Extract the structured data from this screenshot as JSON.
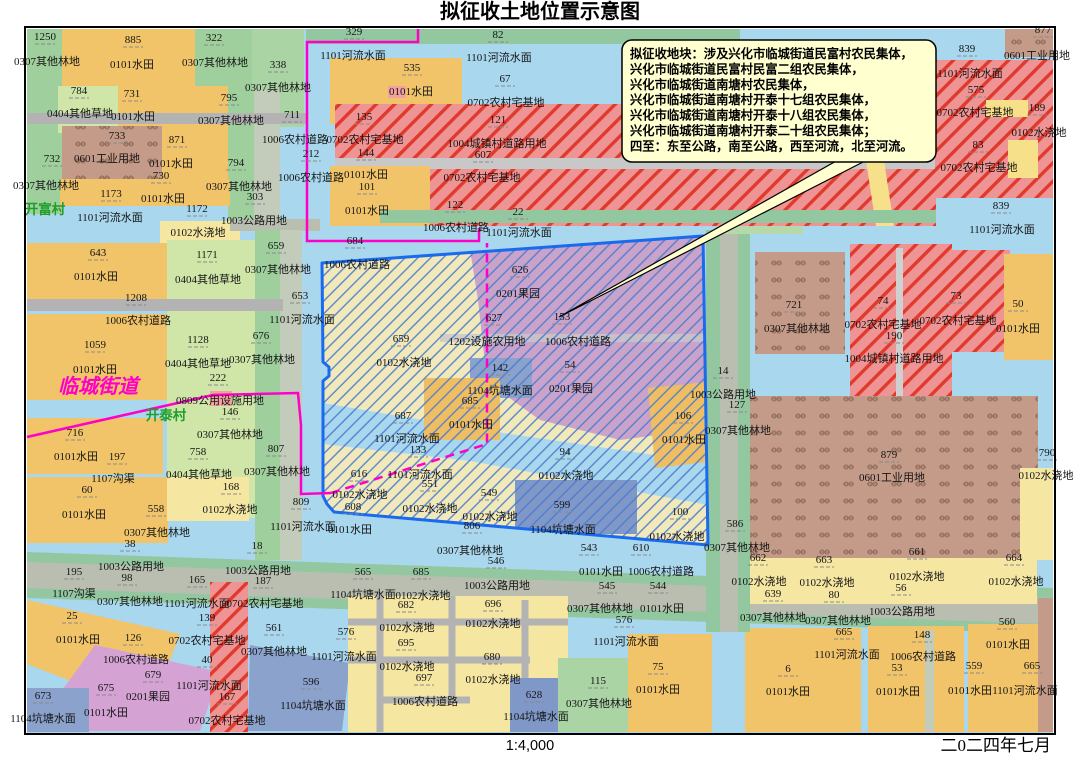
{
  "title": "拟征收土地位置示意图",
  "scale_label": "1:4,000",
  "date_label": "二0二四年七月",
  "callout": {
    "lines": [
      "拟征收地块：涉及兴化市临城街道民富村农民集体，",
      "兴化市临城街道民富村民富二组农民集体，",
      "兴化市临城街道南塘村农民集体，",
      "兴化市临城街道南塘村开泰十七组农民集体，",
      "兴化市临城街道南塘村开泰十八组农民集体，",
      "兴化市临城街道南塘村开泰二十组农民集体；",
      "四至：东至公路，南至公路，西至河流，北至河流。"
    ]
  },
  "legend_colors": {
    "water": "#a9d7ee",
    "paddy_field": "#f2c469",
    "irrigated_land": "#f5e6a2",
    "forest_strip": "#9fcf9c",
    "grass": "#cfe6a8",
    "village_road": "#b3b3b3",
    "highway": "#b9beb0",
    "road_verge": "#93c7a0",
    "residential_red": "#ef9494",
    "residential_hatch": "#e03a2e",
    "industrial_brown": "#c49a88",
    "orchard_purple": "#c9a3c9",
    "orchard_pink": "#d4a3d4",
    "pond_slate": "#8aa2cc",
    "zone_border": "#1a6aee",
    "zone_hatch": "#4a7cd0",
    "admin_boundary": "#ff00c8",
    "village_text": "#1f9e2c",
    "callout_bg": "#ffffd0"
  },
  "map": {
    "labels": [
      [
        45,
        40,
        "1250",
        "n"
      ],
      [
        47,
        65,
        "0307其他林地",
        "c"
      ],
      [
        133,
        43,
        "885",
        "n"
      ],
      [
        132,
        68,
        "0101水田",
        "c"
      ],
      [
        214,
        41,
        "322",
        "n"
      ],
      [
        215,
        66,
        "0307其他林地",
        "c"
      ],
      [
        278,
        68,
        "338",
        "n"
      ],
      [
        278,
        91,
        "0307其他林地",
        "c"
      ],
      [
        79,
        94,
        "784",
        "n"
      ],
      [
        132,
        97,
        "731",
        "n"
      ],
      [
        80,
        117,
        "0404其他草地",
        "c"
      ],
      [
        133,
        120,
        "0101水田",
        "c"
      ],
      [
        229,
        101,
        "795",
        "n"
      ],
      [
        231,
        124,
        "0307其他林地",
        "c"
      ],
      [
        292,
        118,
        "711",
        "n"
      ],
      [
        295,
        143,
        "1006农村道路",
        "c"
      ],
      [
        117,
        139,
        "733",
        "n"
      ],
      [
        107,
        162,
        "0601工业用地",
        "c"
      ],
      [
        177,
        143,
        "871",
        "n"
      ],
      [
        171,
        167,
        "0101水田",
        "c"
      ],
      [
        161,
        179,
        "730",
        "n"
      ],
      [
        52,
        162,
        "732",
        "n"
      ],
      [
        46,
        189,
        "0307其他林地",
        "c"
      ],
      [
        236,
        166,
        "794",
        "n"
      ],
      [
        239,
        190,
        "0307其他林地",
        "c"
      ],
      [
        255,
        200,
        "303",
        "n"
      ],
      [
        111,
        197,
        "1173",
        "n"
      ],
      [
        163,
        202,
        "0101水田",
        "c"
      ],
      [
        45,
        214,
        "开富村",
        "v"
      ],
      [
        110,
        221,
        "1101河流水面",
        "c"
      ],
      [
        197,
        212,
        "1172",
        "n"
      ],
      [
        254,
        224,
        "1003公路用地",
        "c"
      ],
      [
        198,
        236,
        "0102水浇地",
        "c"
      ],
      [
        276,
        249,
        "659",
        "n"
      ],
      [
        278,
        273,
        "0307其他林地",
        "c"
      ],
      [
        207,
        258,
        "1171",
        "n"
      ],
      [
        208,
        283,
        "0404其他草地",
        "c"
      ],
      [
        98,
        256,
        "643",
        "n"
      ],
      [
        96,
        280,
        "0101水田",
        "c"
      ],
      [
        136,
        301,
        "1208",
        "n"
      ],
      [
        138,
        324,
        "1006农村道路",
        "c"
      ],
      [
        300,
        299,
        "653",
        "n"
      ],
      [
        302,
        323,
        "1101河流水面",
        "c"
      ],
      [
        95,
        348,
        "1059",
        "n"
      ],
      [
        95,
        373,
        "0101水田",
        "c"
      ],
      [
        198,
        343,
        "1128",
        "n"
      ],
      [
        198,
        367,
        "0404其他草地",
        "c"
      ],
      [
        261,
        339,
        "676",
        "n"
      ],
      [
        262,
        363,
        "0307其他林地",
        "c"
      ],
      [
        218,
        381,
        "222",
        "n"
      ],
      [
        98,
        393,
        "临城街道",
        "t"
      ],
      [
        220,
        404,
        "0809公用设施用地",
        "c"
      ],
      [
        230,
        415,
        "146",
        "n"
      ],
      [
        166,
        420,
        "开泰村",
        "v"
      ],
      [
        230,
        438,
        "0307其他林地",
        "c"
      ],
      [
        75,
        436,
        "716",
        "n"
      ],
      [
        76,
        460,
        "0101水田",
        "c"
      ],
      [
        117,
        460,
        "197",
        "n"
      ],
      [
        198,
        455,
        "758",
        "n"
      ],
      [
        276,
        452,
        "807",
        "n"
      ],
      [
        277,
        475,
        "0307其他林地",
        "c"
      ],
      [
        113,
        482,
        "1107沟渠",
        "c"
      ],
      [
        87,
        493,
        "60",
        "n"
      ],
      [
        199,
        478,
        "0404其他草地",
        "c"
      ],
      [
        231,
        490,
        "168",
        "n"
      ],
      [
        156,
        512,
        "558",
        "n"
      ],
      [
        84,
        518,
        "0101水田",
        "c"
      ],
      [
        230,
        513,
        "0102水浇地",
        "c"
      ],
      [
        157,
        536,
        "0307其他林地",
        "c"
      ],
      [
        130,
        547,
        "38",
        "n"
      ],
      [
        301,
        505,
        "809",
        "n"
      ],
      [
        303,
        530,
        "1101河流水面",
        "c"
      ],
      [
        350,
        533,
        "0101水田",
        "c"
      ],
      [
        74,
        575,
        "195",
        "n"
      ],
      [
        131,
        570,
        "1003公路用地",
        "c"
      ],
      [
        127,
        581,
        "98",
        "n"
      ],
      [
        257,
        549,
        "18",
        "n"
      ],
      [
        258,
        574,
        "1003公路用地",
        "c"
      ],
      [
        197,
        583,
        "165",
        "n"
      ],
      [
        263,
        584,
        "187",
        "n"
      ],
      [
        74,
        597,
        "1107沟渠",
        "c"
      ],
      [
        130,
        605,
        "0307其他林地",
        "c"
      ],
      [
        197,
        607,
        "1101河流水面",
        "c"
      ],
      [
        265,
        607,
        "0702农村宅基地",
        "c"
      ],
      [
        207,
        621,
        "139",
        "n"
      ],
      [
        72,
        619,
        "25",
        "n"
      ],
      [
        78,
        643,
        "0101水田",
        "c"
      ],
      [
        133,
        641,
        "126",
        "n"
      ],
      [
        207,
        644,
        "0702农村宅基地",
        "c"
      ],
      [
        274,
        631,
        "561",
        "n"
      ],
      [
        274,
        655,
        "0307其他林地",
        "c"
      ],
      [
        136,
        663,
        "1006农村道路",
        "c"
      ],
      [
        153,
        678,
        "679",
        "n"
      ],
      [
        207,
        663,
        "40",
        "n"
      ],
      [
        106,
        691,
        "675",
        "n"
      ],
      [
        148,
        700,
        "0201果园",
        "c"
      ],
      [
        209,
        689,
        "1101河流水面",
        "c"
      ],
      [
        227,
        700,
        "167",
        "n"
      ],
      [
        311,
        685,
        "596",
        "n"
      ],
      [
        313,
        709,
        "1104坑塘水面",
        "c"
      ],
      [
        43,
        699,
        "673",
        "n"
      ],
      [
        43,
        722,
        "1104坑塘水面",
        "c"
      ],
      [
        106,
        716,
        "0101水田",
        "c"
      ],
      [
        227,
        724,
        "0702农村宅基地",
        "c"
      ],
      [
        354,
        35,
        "329",
        "n"
      ],
      [
        498,
        38,
        "82",
        "n"
      ],
      [
        353,
        59,
        "1101河流水面",
        "c"
      ],
      [
        412,
        71,
        "535",
        "n"
      ],
      [
        499,
        61,
        "1101河流水面",
        "c"
      ],
      [
        411,
        95,
        "0101水田",
        "c"
      ],
      [
        505,
        82,
        "67",
        "n"
      ],
      [
        506,
        106,
        "0702农村宅基地",
        "c"
      ],
      [
        364,
        120,
        "135",
        "n"
      ],
      [
        498,
        123,
        "121",
        "n"
      ],
      [
        365,
        143,
        "0702农村宅基地",
        "c"
      ],
      [
        366,
        156,
        "144",
        "n"
      ],
      [
        497,
        147,
        "1004城镇村道路用地",
        "c"
      ],
      [
        483,
        158,
        "607",
        "n"
      ],
      [
        482,
        181,
        "0702农村宅基地",
        "c"
      ],
      [
        311,
        157,
        "212",
        "n"
      ],
      [
        311,
        181,
        "1006农村道路",
        "c"
      ],
      [
        366,
        178,
        "0101水田",
        "c"
      ],
      [
        367,
        190,
        "101",
        "n"
      ],
      [
        367,
        214,
        "0101水田",
        "c"
      ],
      [
        455,
        208,
        "122",
        "n"
      ],
      [
        518,
        215,
        "22",
        "n"
      ],
      [
        456,
        231,
        "1006农村道路",
        "c"
      ],
      [
        519,
        236,
        "1101河流水面",
        "c"
      ],
      [
        355,
        244,
        "684",
        "n"
      ],
      [
        1043,
        33,
        "877",
        "n"
      ],
      [
        1037,
        59,
        "0601工业用地",
        "c"
      ],
      [
        967,
        52,
        "839",
        "n"
      ],
      [
        970,
        77,
        "1101河流水面",
        "c"
      ],
      [
        976,
        93,
        "575",
        "n"
      ],
      [
        975,
        116,
        "0702农村宅基地",
        "c"
      ],
      [
        1037,
        111,
        "189",
        "n"
      ],
      [
        1039,
        136,
        "0102水浇地",
        "c"
      ],
      [
        978,
        148,
        "83",
        "n"
      ],
      [
        979,
        171,
        "0702农村宅基地",
        "c"
      ],
      [
        1001,
        209,
        "839",
        "n"
      ],
      [
        1002,
        233,
        "1101河流水面",
        "c"
      ],
      [
        357,
        268,
        "1006农村道路",
        "c"
      ],
      [
        520,
        273,
        "626",
        "n"
      ],
      [
        518,
        297,
        "0201果园",
        "c"
      ],
      [
        494,
        321,
        "627",
        "n"
      ],
      [
        562,
        320,
        "153",
        "n"
      ],
      [
        487,
        345,
        "1202设施农用地",
        "c"
      ],
      [
        578,
        345,
        "1006农村道路",
        "c"
      ],
      [
        401,
        342,
        "659",
        "n"
      ],
      [
        404,
        366,
        "0102水浇地",
        "c"
      ],
      [
        500,
        371,
        "142",
        "n"
      ],
      [
        570,
        368,
        "54",
        "n"
      ],
      [
        500,
        394,
        "1104坑塘水面",
        "c"
      ],
      [
        571,
        392,
        "0201果园",
        "c"
      ],
      [
        470,
        404,
        "685",
        "n"
      ],
      [
        471,
        428,
        "0101水田",
        "c"
      ],
      [
        403,
        419,
        "687",
        "n"
      ],
      [
        407,
        442,
        "1101河流水面",
        "c"
      ],
      [
        418,
        453,
        "133",
        "n"
      ],
      [
        359,
        477,
        "616",
        "n"
      ],
      [
        420,
        478,
        "1101河流水面",
        "c"
      ],
      [
        430,
        487,
        "551",
        "n"
      ],
      [
        565,
        455,
        "94",
        "n"
      ],
      [
        566,
        479,
        "0102水浇地",
        "c"
      ],
      [
        683,
        419,
        "106",
        "n"
      ],
      [
        684,
        443,
        "0101水田",
        "c"
      ],
      [
        360,
        498,
        "0102水浇地",
        "c"
      ],
      [
        353,
        510,
        "608",
        "n"
      ],
      [
        430,
        512,
        "0102水浇地",
        "c"
      ],
      [
        489,
        496,
        "549",
        "n"
      ],
      [
        490,
        520,
        "0102水浇地",
        "c"
      ],
      [
        562,
        508,
        "599",
        "n"
      ],
      [
        563,
        533,
        "1104坑塘水面",
        "c"
      ],
      [
        680,
        515,
        "100",
        "n"
      ],
      [
        677,
        540,
        "0102水浇地",
        "c"
      ],
      [
        472,
        529,
        "806",
        "n"
      ],
      [
        470,
        554,
        "0307其他林地",
        "c"
      ],
      [
        496,
        564,
        "546",
        "n"
      ],
      [
        589,
        551,
        "543",
        "n"
      ],
      [
        641,
        551,
        "610",
        "n"
      ],
      [
        794,
        308,
        "721",
        "n"
      ],
      [
        797,
        332,
        "0307其他林地",
        "c"
      ],
      [
        883,
        304,
        "74",
        "n"
      ],
      [
        883,
        328,
        "0702农村宅基地",
        "c"
      ],
      [
        894,
        339,
        "190",
        "n"
      ],
      [
        894,
        362,
        "1004城镇村道路用地",
        "c"
      ],
      [
        956,
        299,
        "73",
        "n"
      ],
      [
        958,
        324,
        "0702农村宅基地",
        "c"
      ],
      [
        1018,
        307,
        "50",
        "n"
      ],
      [
        1018,
        332,
        "0101水田",
        "c"
      ],
      [
        723,
        374,
        "14",
        "n"
      ],
      [
        723,
        398,
        "1003公路用地",
        "c"
      ],
      [
        737,
        408,
        "127",
        "n"
      ],
      [
        738,
        434,
        "0307其他林地",
        "c"
      ],
      [
        889,
        458,
        "879",
        "n"
      ],
      [
        892,
        481,
        "0601工业用地",
        "c"
      ],
      [
        1047,
        456,
        "790",
        "n"
      ],
      [
        1046,
        479,
        "0102水浇地",
        "c"
      ],
      [
        735,
        527,
        "586",
        "n"
      ],
      [
        737,
        551,
        "0307其他林地",
        "c"
      ],
      [
        758,
        561,
        "662",
        "n"
      ],
      [
        759,
        585,
        "0102水浇地",
        "c"
      ],
      [
        773,
        597,
        "639",
        "n"
      ],
      [
        824,
        563,
        "663",
        "n"
      ],
      [
        827,
        586,
        "0102水浇地",
        "c"
      ],
      [
        834,
        598,
        "80",
        "n"
      ],
      [
        917,
        555,
        "661",
        "n"
      ],
      [
        917,
        580,
        "0102水浇地",
        "c"
      ],
      [
        901,
        591,
        "56",
        "n"
      ],
      [
        1014,
        561,
        "664",
        "n"
      ],
      [
        1016,
        585,
        "0102水浇地",
        "c"
      ],
      [
        902,
        615,
        "1003公路用地",
        "c"
      ],
      [
        773,
        621,
        "0307其他林地",
        "c"
      ],
      [
        838,
        624,
        "0307其他林地",
        "c"
      ],
      [
        844,
        635,
        "665",
        "n"
      ],
      [
        922,
        638,
        "148",
        "n"
      ],
      [
        923,
        660,
        "1006农村道路",
        "c"
      ],
      [
        1007,
        625,
        "560",
        "n"
      ],
      [
        1008,
        648,
        "0101水田",
        "c"
      ],
      [
        847,
        658,
        "1101河流水面",
        "c"
      ],
      [
        788,
        672,
        "6",
        "n"
      ],
      [
        788,
        695,
        "0101水田",
        "c"
      ],
      [
        897,
        671,
        "53",
        "n"
      ],
      [
        898,
        695,
        "0101水田",
        "c"
      ],
      [
        974,
        669,
        "559",
        "n"
      ],
      [
        970,
        694,
        "0101水田",
        "c"
      ],
      [
        1032,
        669,
        "665",
        "n"
      ],
      [
        1025,
        694,
        "1101河流水面",
        "c"
      ],
      [
        363,
        575,
        "565",
        "n"
      ],
      [
        421,
        575,
        "685",
        "n"
      ],
      [
        363,
        598,
        "1104坑塘水面",
        "c"
      ],
      [
        423,
        599,
        "0102水浇地",
        "c"
      ],
      [
        497,
        589,
        "1003公路用地",
        "c"
      ],
      [
        601,
        575,
        "0101水田",
        "c"
      ],
      [
        661,
        575,
        "1006农村道路",
        "c"
      ],
      [
        607,
        589,
        "545",
        "n"
      ],
      [
        658,
        589,
        "544",
        "n"
      ],
      [
        406,
        608,
        "682",
        "n"
      ],
      [
        493,
        607,
        "696",
        "n"
      ],
      [
        407,
        631,
        "0102水浇地",
        "c"
      ],
      [
        493,
        627,
        "0102水浇地",
        "c"
      ],
      [
        600,
        612,
        "0307其他林地",
        "c"
      ],
      [
        662,
        612,
        "0101水田",
        "c"
      ],
      [
        624,
        623,
        "576",
        "n"
      ],
      [
        626,
        645,
        "1101河流水面",
        "c"
      ],
      [
        406,
        646,
        "695",
        "n"
      ],
      [
        407,
        670,
        "0102水浇地",
        "c"
      ],
      [
        492,
        660,
        "680",
        "n"
      ],
      [
        493,
        683,
        "0102水浇地",
        "c"
      ],
      [
        424,
        681,
        "697",
        "n"
      ],
      [
        425,
        705,
        "1006农村道路",
        "c"
      ],
      [
        346,
        635,
        "576",
        "n"
      ],
      [
        344,
        660,
        "1101河流水面",
        "c"
      ],
      [
        534,
        698,
        "628",
        "n"
      ],
      [
        536,
        720,
        "1104坑塘水面",
        "c"
      ],
      [
        598,
        684,
        "115",
        "n"
      ],
      [
        599,
        707,
        "0307其他林地",
        "c"
      ],
      [
        658,
        670,
        "75",
        "n"
      ],
      [
        658,
        693,
        "0101水田",
        "c"
      ]
    ]
  }
}
